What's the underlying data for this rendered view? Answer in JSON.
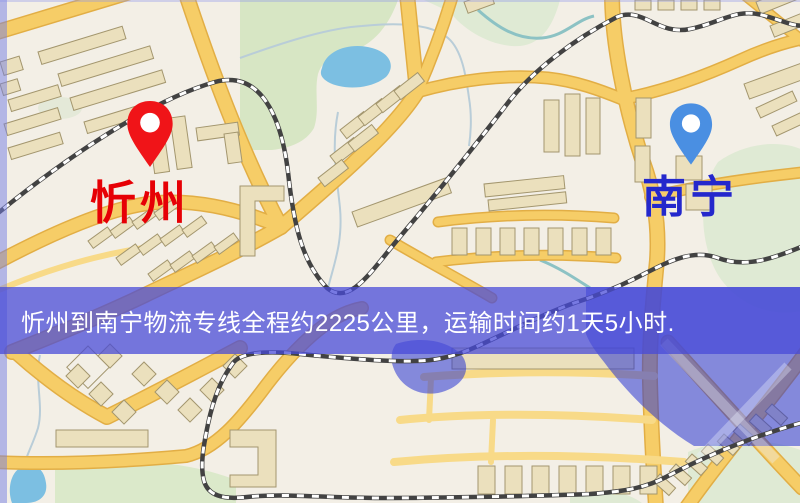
{
  "banner": {
    "text": "忻州到南宁物流专线全程约2225公里，运输时间约1天5小时.",
    "bg_color": "rgba(72,74,216,0.74)",
    "text_color": "#ffffff"
  },
  "origin": {
    "name": "忻州",
    "label_color": "#e60005",
    "pin_color": "#f01418"
  },
  "destination": {
    "name": "南宁",
    "label_color": "#2428cc",
    "pin_color": "#4a8fe2"
  },
  "map_colors": {
    "background": "#f3efe6",
    "road_fill": "#f6cd67",
    "road_casing": "#e2ae45",
    "road_minor": "#f8da88",
    "building": "#ebe0bd",
    "building_outline": "#a3966e",
    "park": "#d7e6c4",
    "park_pale": "#dfead4",
    "lake": "#7cbfe2",
    "stream": "#b9cdd8",
    "railway_base": "#424242",
    "railway_dash": "#ffffff",
    "overlay_water": "rgba(40,52,210,0.55)"
  }
}
